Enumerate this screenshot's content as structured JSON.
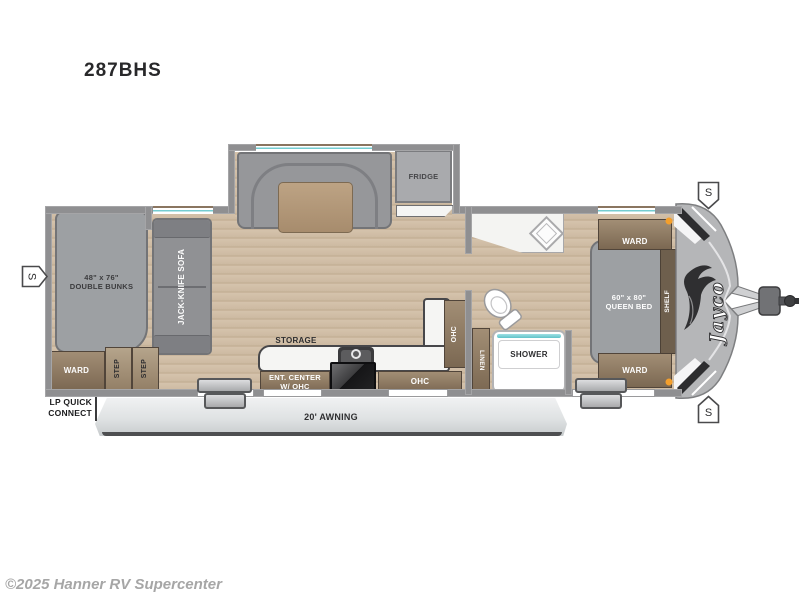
{
  "title": "287BHS",
  "watermark": "©2025 Hanner RV Supercenter",
  "brand": "Jayco",
  "speaker": "S",
  "colors": {
    "wall": "#8f8f91",
    "floor_wood": "#d0bea7",
    "cabinet_brown": "#7b6852",
    "furniture_gray": "#9da0a3",
    "counter_white": "#f5f5f3",
    "window_teal": "#74ccd1",
    "awning_gray": "#d9dcde",
    "front_cap_gray": "#b5b6b8",
    "marker_light_orange": "#f49f2c"
  },
  "labels": {
    "bunks_size": "48\" x 76\"",
    "bunks_name": "DOUBLE BUNKS",
    "sofa": "JACK-KNIFE SOFA",
    "ward_rear": "WARD",
    "step_front": "STEP",
    "step_back": "STEP",
    "lp_line1": "LP QUICK",
    "lp_line2": "CONNECT",
    "fridge": "FRIDGE",
    "storage": "STORAGE",
    "ent_center_line1": "ENT. CENTER",
    "ent_center_line2": "W/ OHC",
    "ohc_kitchen": "OHC",
    "ohc_side": "OHC",
    "linen": "LINEN",
    "shower": "SHOWER",
    "bed_size": "60\" x 80\"",
    "bed_name": "QUEEN BED",
    "shelf": "SHELF",
    "ward_top": "WARD",
    "ward_bottom": "WARD",
    "awning": "20' AWNING"
  }
}
